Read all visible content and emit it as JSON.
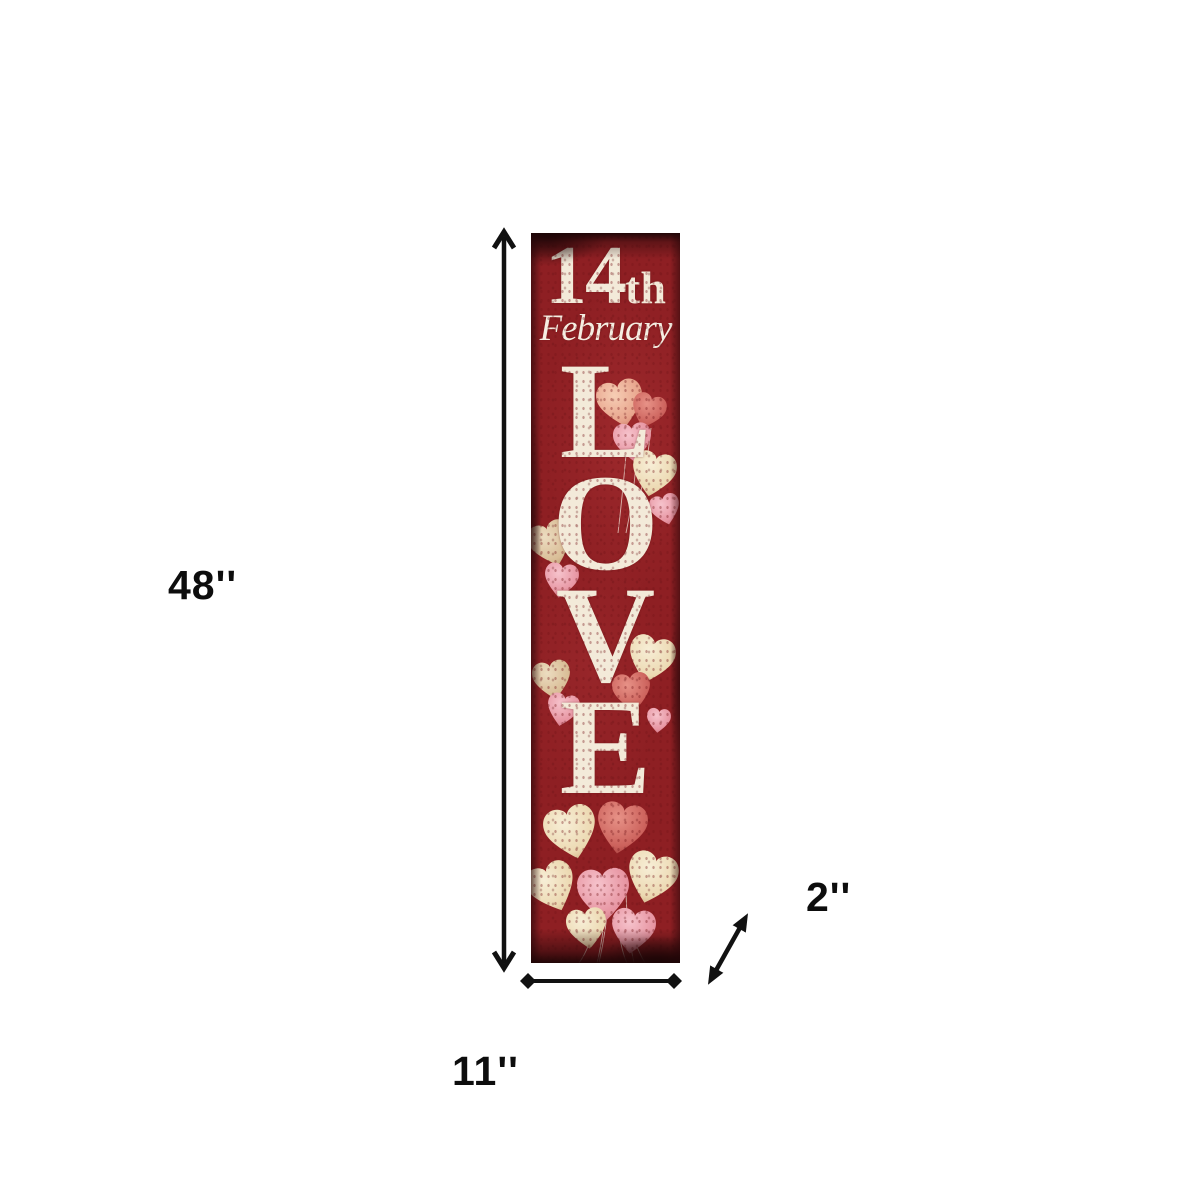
{
  "canvas": {
    "background": "#ffffff"
  },
  "sign": {
    "line1_number": "14",
    "line1_suffix": "th",
    "line2": "February",
    "word": "LOVE",
    "word_letters": [
      "L",
      "O",
      "V",
      "E"
    ],
    "artwork": "heart-shaped balloons in cream, pink and red",
    "colors": {
      "board_red": "#8e1f23",
      "edge_dark": "#2e0608",
      "lettering": "#f3ead9",
      "balloon_cream": "#f0e3c6",
      "balloon_pink": "#e79aa6",
      "balloon_red": "#c85a58"
    }
  },
  "dimensions": {
    "height_label": "48''",
    "width_label": "11''",
    "depth_label": "2''",
    "arrow_color": "#111111"
  }
}
